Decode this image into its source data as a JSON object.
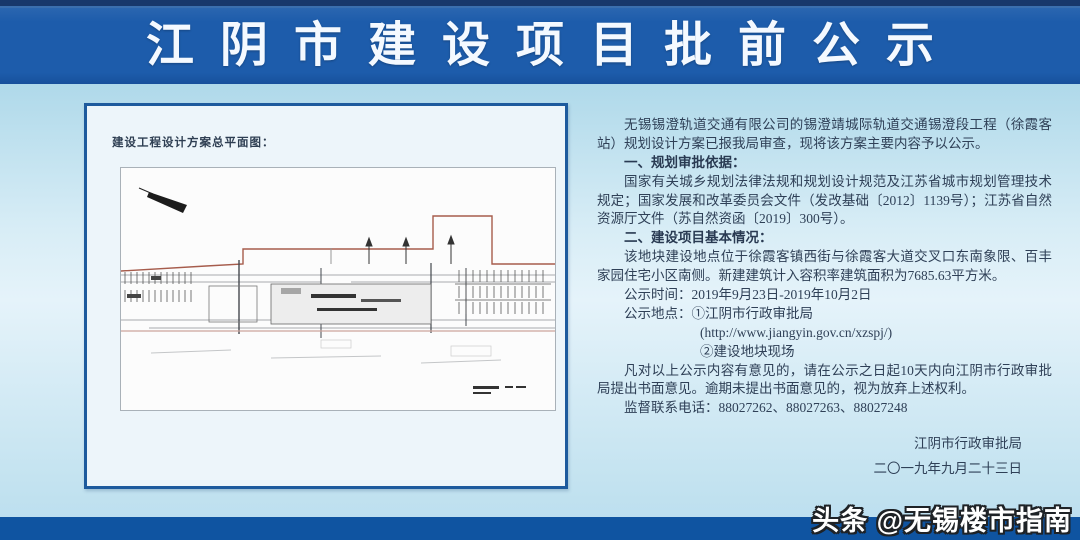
{
  "title": "江阴市建设项目批前公示",
  "panel": {
    "label": "建设工程设计方案总平面图："
  },
  "notice": {
    "intro": "无锡锡澄轨道交通有限公司的锡澄靖城际轨道交通锡澄段工程（徐霞客站）规划设计方案已报我局审查，现将该方案主要内容予以公示。",
    "s1_head": "一、规划审批依据：",
    "s1_body": "国家有关城乡规划法律法规和规划设计规范及江苏省城市规划管理技术规定；国家发展和改革委员会文件（发改基础〔2012〕1139号）；江苏省自然资源厅文件（苏自然资函〔2019〕300号）。",
    "s2_head": "二、建设项目基本情况：",
    "s2_body": "该地块建设地点位于徐霞客镇西街与徐霞客大道交叉口东南象限、百丰家园住宅小区南侧。新建建筑计入容积率建筑面积为7685.63平方米。",
    "time": "公示时间：2019年9月23日-2019年10月2日",
    "place1": "公示地点：①江阴市行政审批局",
    "url": "(http://www.jiangyin.gov.cn/xzspj/)",
    "place2": "②建设地块现场",
    "objection": "凡对以上公示内容有意见的，请在公示之日起10天内向江阴市行政审批局提出书面意见。逾期未提出书面意见的，视为放弃上述权利。",
    "phone": "监督联系电话：88027262、88027263、88027248",
    "issuer": "江阴市行政审批局",
    "date": "二〇一九年九月二十三日"
  },
  "watermark": "头条 @无锡楼市指南",
  "colors": {
    "header_blue": "#1d5cab",
    "strip_navy": "#17386b",
    "bottom_blue": "#0f54a1",
    "body_blue": "#c5e4f2",
    "panel_border_blue": "#1d5a9d",
    "boundary_red": "#a65c4c"
  }
}
